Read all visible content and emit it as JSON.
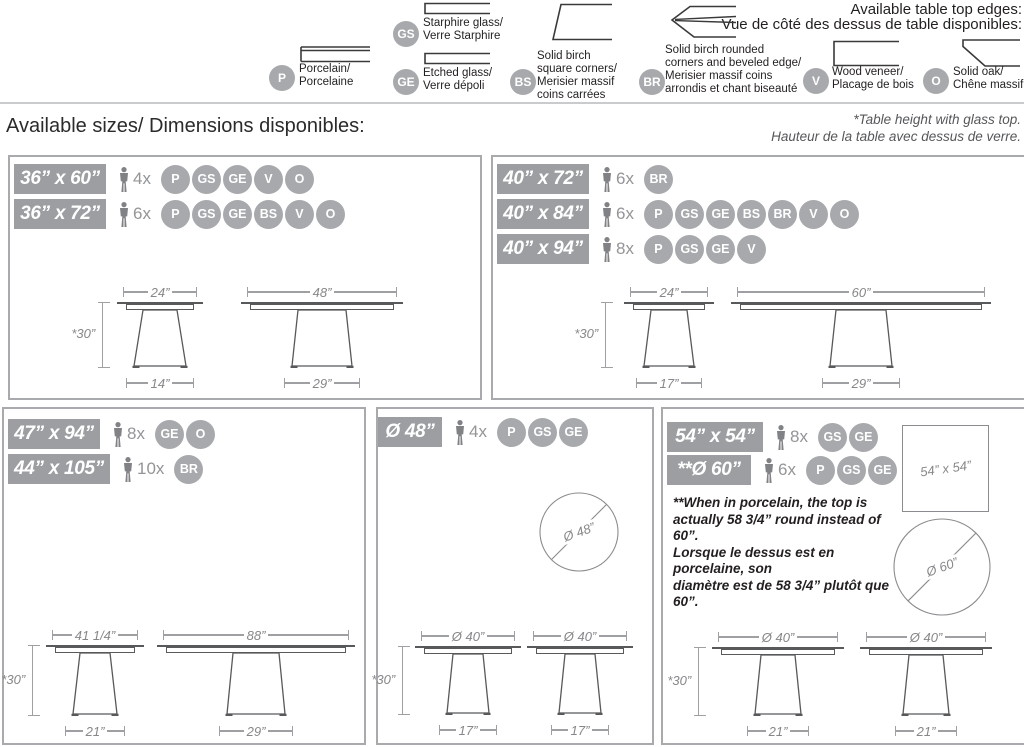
{
  "edges_header": {
    "line1": "Available table top edges:",
    "line2": "Vue de côté des dessus de table disponibles:"
  },
  "legend": [
    {
      "code": "P",
      "lines": [
        "Porcelain/",
        "Porcelaine"
      ]
    },
    {
      "code": "GS",
      "lines": [
        "Starphire glass/",
        "Verre Starphire"
      ]
    },
    {
      "code": "GE",
      "lines": [
        "Etched glass/",
        "Verre dépoli"
      ]
    },
    {
      "code": "BS",
      "lines": [
        "Solid birch",
        "square corners/",
        "Merisier massif",
        "coins carrées"
      ]
    },
    {
      "code": "BR",
      "lines": [
        "Solid birch rounded",
        "corners and beveled edge/",
        "Merisier massif coins",
        "arrondis et chant biseauté"
      ]
    },
    {
      "code": "V",
      "lines": [
        "Wood veneer/",
        "Placage de bois"
      ]
    },
    {
      "code": "O",
      "lines": [
        "Solid oak/",
        "Chêne massif"
      ]
    }
  ],
  "sizes_title": "Available sizes/ Dimensions disponibles:",
  "footnote": {
    "line1": "*Table height with glass top.",
    "line2": "Hauteur de la table avec dessus de verre."
  },
  "panels": {
    "a": {
      "rows": [
        {
          "size": "36” x 60”",
          "seats": "4x",
          "materials": [
            "P",
            "GS",
            "GE",
            "V",
            "O"
          ]
        },
        {
          "size": "36” x 72”",
          "seats": "6x",
          "materials": [
            "P",
            "GS",
            "GE",
            "BS",
            "V",
            "O"
          ]
        }
      ],
      "figures": [
        {
          "top": "24”",
          "height": "*30”",
          "base": "14”"
        },
        {
          "top": "48”",
          "base": "29”"
        }
      ]
    },
    "b": {
      "rows": [
        {
          "size": "40” x 72”",
          "seats": "6x",
          "materials": [
            "BR"
          ]
        },
        {
          "size": "40” x 84”",
          "seats": "6x",
          "materials": [
            "P",
            "GS",
            "GE",
            "BS",
            "BR",
            "V",
            "O"
          ]
        },
        {
          "size": "40” x 94”",
          "seats": "8x",
          "materials": [
            "P",
            "GS",
            "GE",
            "V"
          ]
        }
      ],
      "figures": [
        {
          "top": "24”",
          "height": "*30”",
          "base": "17”"
        },
        {
          "top": "60”",
          "base": "29”"
        }
      ]
    },
    "c": {
      "rows": [
        {
          "size": "47” x 94”",
          "seats": "8x",
          "materials": [
            "GE",
            "O"
          ]
        },
        {
          "size": "44” x 105”",
          "seats": "10x",
          "materials": [
            "BR"
          ]
        }
      ],
      "figures": [
        {
          "top": "41 1/4”",
          "height": "*30”",
          "base": "21”"
        },
        {
          "top": "88”",
          "base": "29”"
        }
      ]
    },
    "d": {
      "rows": [
        {
          "size": "Ø 48”",
          "seats": "4x",
          "materials": [
            "P",
            "GS",
            "GE"
          ]
        }
      ],
      "circle": "Ø 48”",
      "figures": [
        {
          "top": "Ø 40”",
          "height": "*30”",
          "base": "17”"
        },
        {
          "top": "Ø 40”",
          "base": "17”"
        }
      ]
    },
    "e": {
      "rows": [
        {
          "size": "54” x 54”",
          "seats": "8x",
          "materials": [
            "GS",
            "GE"
          ]
        },
        {
          "size": "**Ø 60”",
          "seats": "6x",
          "materials": [
            "P",
            "GS",
            "GE"
          ]
        }
      ],
      "square": "54” x 54”",
      "circle": "Ø 60”",
      "note": [
        "**When in porcelain, the top is",
        "actually 58 3/4” round instead of 60”.",
        "Lorsque le dessus est en porcelaine, son",
        "diamètre est de 58 3/4” plutôt que 60”."
      ],
      "figures": [
        {
          "top": "Ø 40”",
          "height": "*30”",
          "base": "21”"
        },
        {
          "top": "Ø 40”",
          "base": "21”"
        }
      ]
    }
  },
  "colors": {
    "badge": "#9C9EA1",
    "chip": "#A7A9AC",
    "drawing_line": "#58595B",
    "dimension_line": "#9EA0A3"
  }
}
